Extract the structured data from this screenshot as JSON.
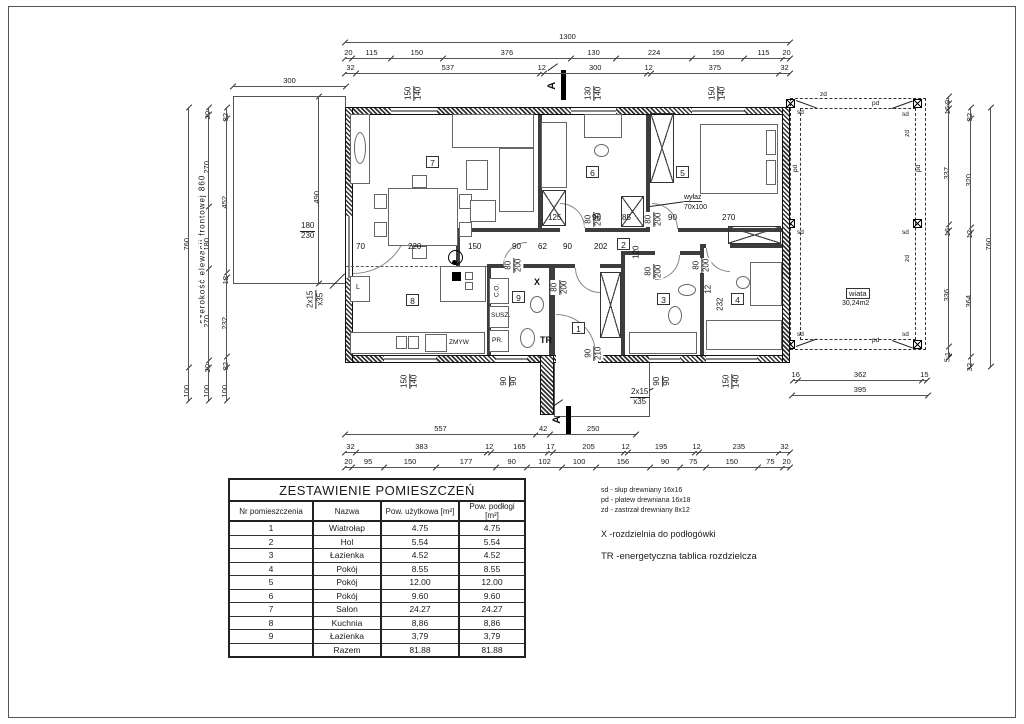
{
  "table": {
    "title": "ZESTAWIENIE POMIESZCZEŃ",
    "headers": [
      "Nr pomieszczenia",
      "Nazwa",
      "Pow. użytkowa [m²]",
      "Pow. podłogi [m²]"
    ],
    "rows": [
      [
        "1",
        "Wiatrołap",
        "4.75",
        "4.75"
      ],
      [
        "2",
        "Hol",
        "5.54",
        "5.54"
      ],
      [
        "3",
        "Łazienka",
        "4.52",
        "4.52"
      ],
      [
        "4",
        "Pokój",
        "8.55",
        "8.55"
      ],
      [
        "5",
        "Pokój",
        "12.00",
        "12.00"
      ],
      [
        "6",
        "Pokój",
        "9.60",
        "9.60"
      ],
      [
        "7",
        "Salon",
        "24.27",
        "24.27"
      ],
      [
        "8",
        "Kuchnia",
        "8,86",
        "8,86"
      ],
      [
        "9",
        "Łazienka",
        "3,79",
        "3,79"
      ],
      [
        "",
        "Razem",
        "81.88",
        "81.88"
      ]
    ]
  },
  "legend": {
    "abbr_lines": [
      "sd - słup drewniany 16x16",
      "pd - płatew drewniana 16x18",
      "zd - zastrzał drewniany 8x12"
    ],
    "x_note": "X -rozdzielnia do podłogówki",
    "tr_note": "TR -energetyczna tablica rozdzielcza"
  },
  "chains": {
    "top_total": [
      "1300"
    ],
    "top_a": [
      "20",
      "115",
      "150",
      "376",
      "130",
      "224",
      "150",
      "115",
      "20"
    ],
    "top_b": [
      "32",
      "537",
      "12",
      "300",
      "12",
      "375",
      "32"
    ],
    "left_text": "szerokość elewacji frontowej 860",
    "left_total": [
      "760",
      "100"
    ],
    "left_a": [
      "20",
      "270",
      "180",
      "270",
      "20",
      "100"
    ],
    "left_b": [
      "32",
      "452",
      "12",
      "232",
      "32",
      "100"
    ],
    "right_inner": [
      "19",
      "16",
      "337",
      "16",
      "336",
      "31",
      "5"
    ],
    "right_mid": [
      "32",
      "320",
      "12",
      "364",
      "32"
    ],
    "right_outer": [
      "760"
    ],
    "bottom_partial": [
      "557",
      "42",
      "250"
    ],
    "bottom_a": [
      "32",
      "383",
      "12",
      "165",
      "17",
      "205",
      "12",
      "195",
      "12",
      "235",
      "32"
    ],
    "bottom_b": [
      "20",
      "95",
      "150",
      "177",
      "90",
      "102",
      "100",
      "156",
      "90",
      "75",
      "150",
      "75",
      "20"
    ],
    "wiata_bottom_a": [
      "16",
      "362",
      "15"
    ],
    "wiata_bottom_b": [
      "395"
    ],
    "terrace_w": [
      "300"
    ],
    "terrace_h": [
      "490"
    ]
  },
  "labels": {
    "rooms": {
      "r1": "1",
      "r2": "2",
      "r3": "3",
      "r4": "4",
      "r5": "5",
      "r6": "6",
      "r7": "7",
      "r8": "8",
      "r9": "9"
    },
    "openings": {
      "top_salon": {
        "a": "150",
        "b": "140"
      },
      "top_r6": {
        "a": "130",
        "b": "140"
      },
      "top_r5": {
        "a": "150",
        "b": "140"
      },
      "terrace_door": {
        "a": "180",
        "b": "230"
      },
      "bot_kitchen": {
        "a": "150",
        "b": "140"
      },
      "bot_bath9": {
        "a": "90",
        "b": "90"
      },
      "entry_door": {
        "a": "90",
        "b": "210"
      },
      "bot_bath3": {
        "a": "90",
        "b": "90"
      },
      "bot_r4": {
        "a": "150",
        "b": "140"
      }
    },
    "door_size": {
      "a": "80",
      "b": "200"
    },
    "interior": {
      "i70": "70",
      "i220": "220",
      "i150": "150",
      "i90a": "90",
      "i62": "62",
      "i90b": "90",
      "i202": "202",
      "i120": "120",
      "i125": "125",
      "i90c": "90",
      "i85": "85",
      "i90d": "90",
      "i270": "270",
      "i232": "232",
      "i12": "12"
    },
    "annot": {
      "wiata": "wiata",
      "wiata_area": "30,24m2",
      "wylaz": "wyłaz",
      "wylaz_size": "70x100",
      "x_mark": "X",
      "tr_mark": "TR",
      "susz": "SUSZ.",
      "pr": "PR.",
      "co": "C.O.",
      "fridge": "L",
      "zmyw": "ZMYW",
      "steps_a": "2x15",
      "steps_b": "x35",
      "section": "A",
      "sd": "sd",
      "pd": "pd",
      "zd": "zd"
    }
  }
}
